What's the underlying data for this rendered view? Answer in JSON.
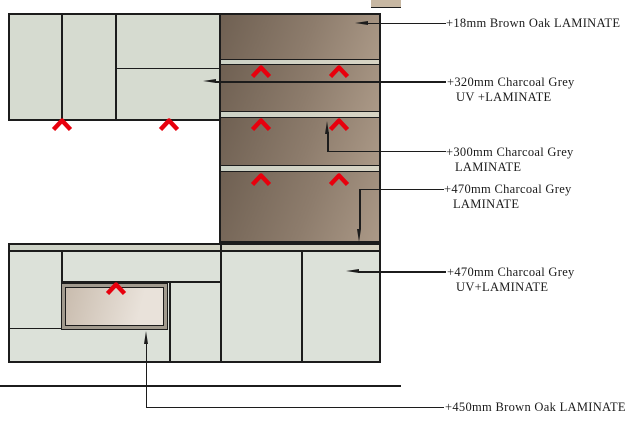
{
  "drawing": {
    "title": "Kitchen cabinet elevation with laminate callouts",
    "annotations": [
      {
        "line1": "+18mm Brown Oak LAMINATE",
        "line2": ""
      },
      {
        "line1": "+320mm Charcoal Grey",
        "line2": "UV +LAMINATE"
      },
      {
        "line1": "+300mm Charcoal Grey",
        "line2": "LAMINATE"
      },
      {
        "line1": "+470mm Charcoal Grey",
        "line2": "LAMINATE"
      },
      {
        "line1": "+470mm Charcoal Grey",
        "line2": "UV+LAMINATE"
      },
      {
        "line1": "+450mm Brown Oak LAMINATE",
        "line2": ""
      }
    ],
    "marker_icon": "red-grain-direction-chevron"
  },
  "colors": {
    "line": "#1c1c1c",
    "sage_wall": "#d6dbd0",
    "sage_door": "#dce1d9",
    "strip_left": "#ccd2c6",
    "strip_right": "#d7d3c3",
    "brown_dark": "#6f6052",
    "brown_mid": "#8d7c6c",
    "brown_light": "#ab9987",
    "red_marker": "#e8000d",
    "niche_frame": "#a19a8e",
    "niche_dark": "#c9bcae",
    "niche_light": "#e9e2da",
    "text": "#1a1a1a",
    "tan_fragment": "#c7b7a2"
  }
}
